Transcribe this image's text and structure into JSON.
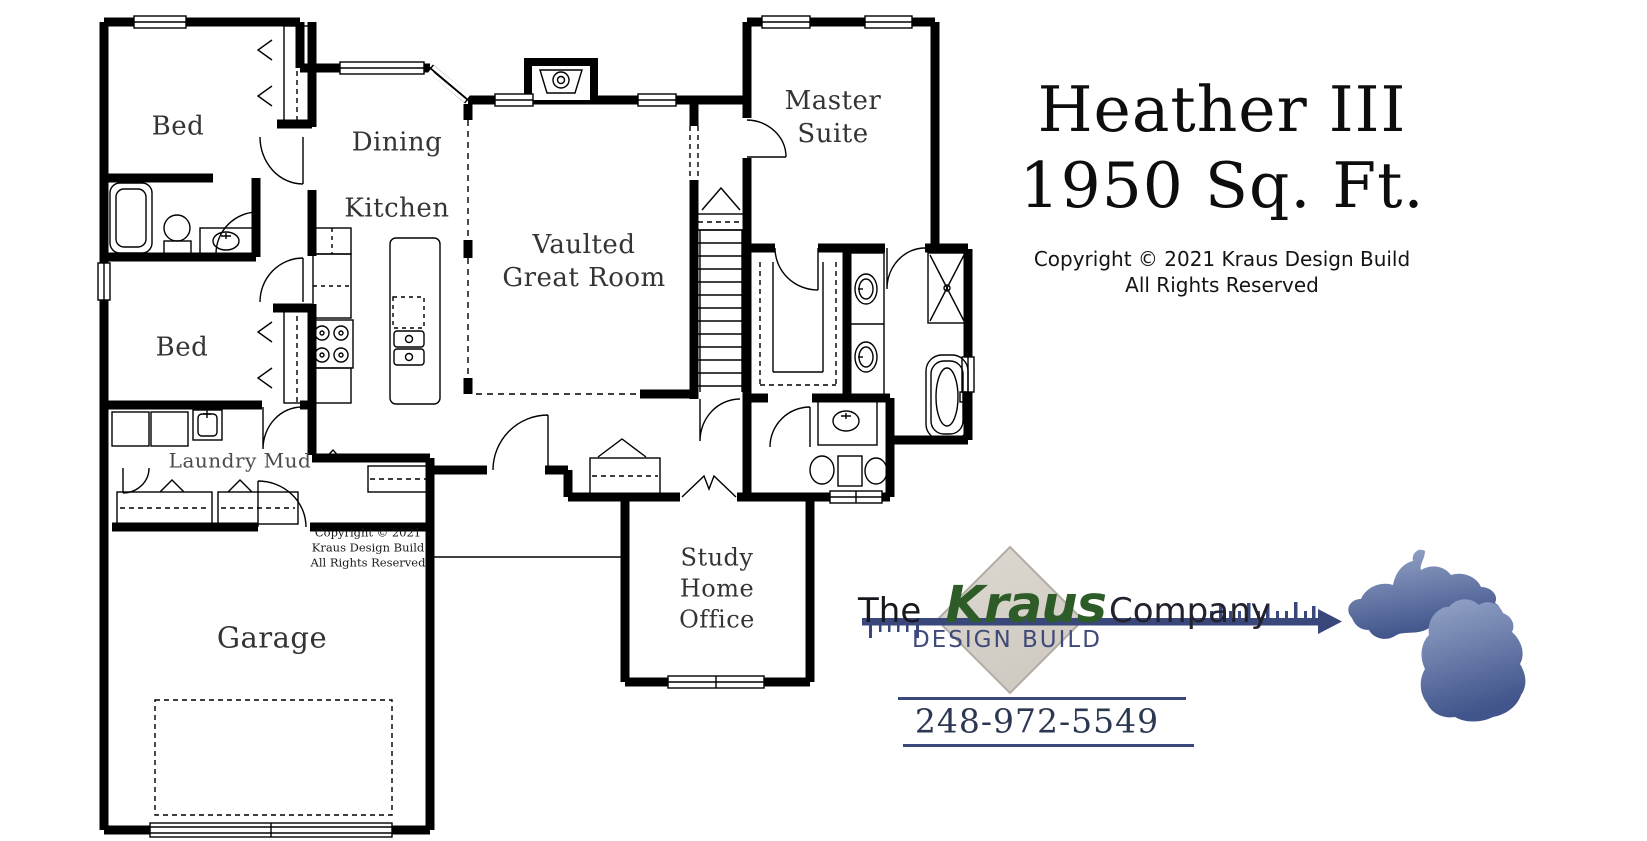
{
  "floor_plan": {
    "labels": {
      "bedroom_top": "Bed",
      "bedroom_bottom": "Bed",
      "dining": "Dining",
      "kitchen": "Kitchen",
      "great_room_line1": "Vaulted",
      "great_room_line2": "Great Room",
      "master_line1": "Master",
      "master_line2": "Suite",
      "laundry": "Laundry Mud",
      "garage": "Garage",
      "study_line1": "Study",
      "study_line2": "Home",
      "study_line3": "Office"
    },
    "stamp": {
      "line1": "Copyright © 2021",
      "line2": "Kraus Design Build",
      "line3": "All Rights Reserved"
    }
  },
  "title_block": {
    "plan_name": "Heather III",
    "area": "1950 Sq. Ft.",
    "copyright_line1": "Copyright © 2021 Kraus Design Build",
    "copyright_line2": "All Rights Reserved"
  },
  "branding": {
    "prefix": "The",
    "name": "Kraus",
    "suffix": "Company",
    "tagline": "DESIGN BUILD",
    "phone": "248-972-5549"
  },
  "colors": {
    "kraus_green": "#2d5c28",
    "logo_navy": "#3a477b",
    "diamond_fill": "#d7d3ca",
    "michigan_light": "#96a6c9",
    "michigan_dark": "#41548b",
    "plan_ink": "#000000"
  }
}
